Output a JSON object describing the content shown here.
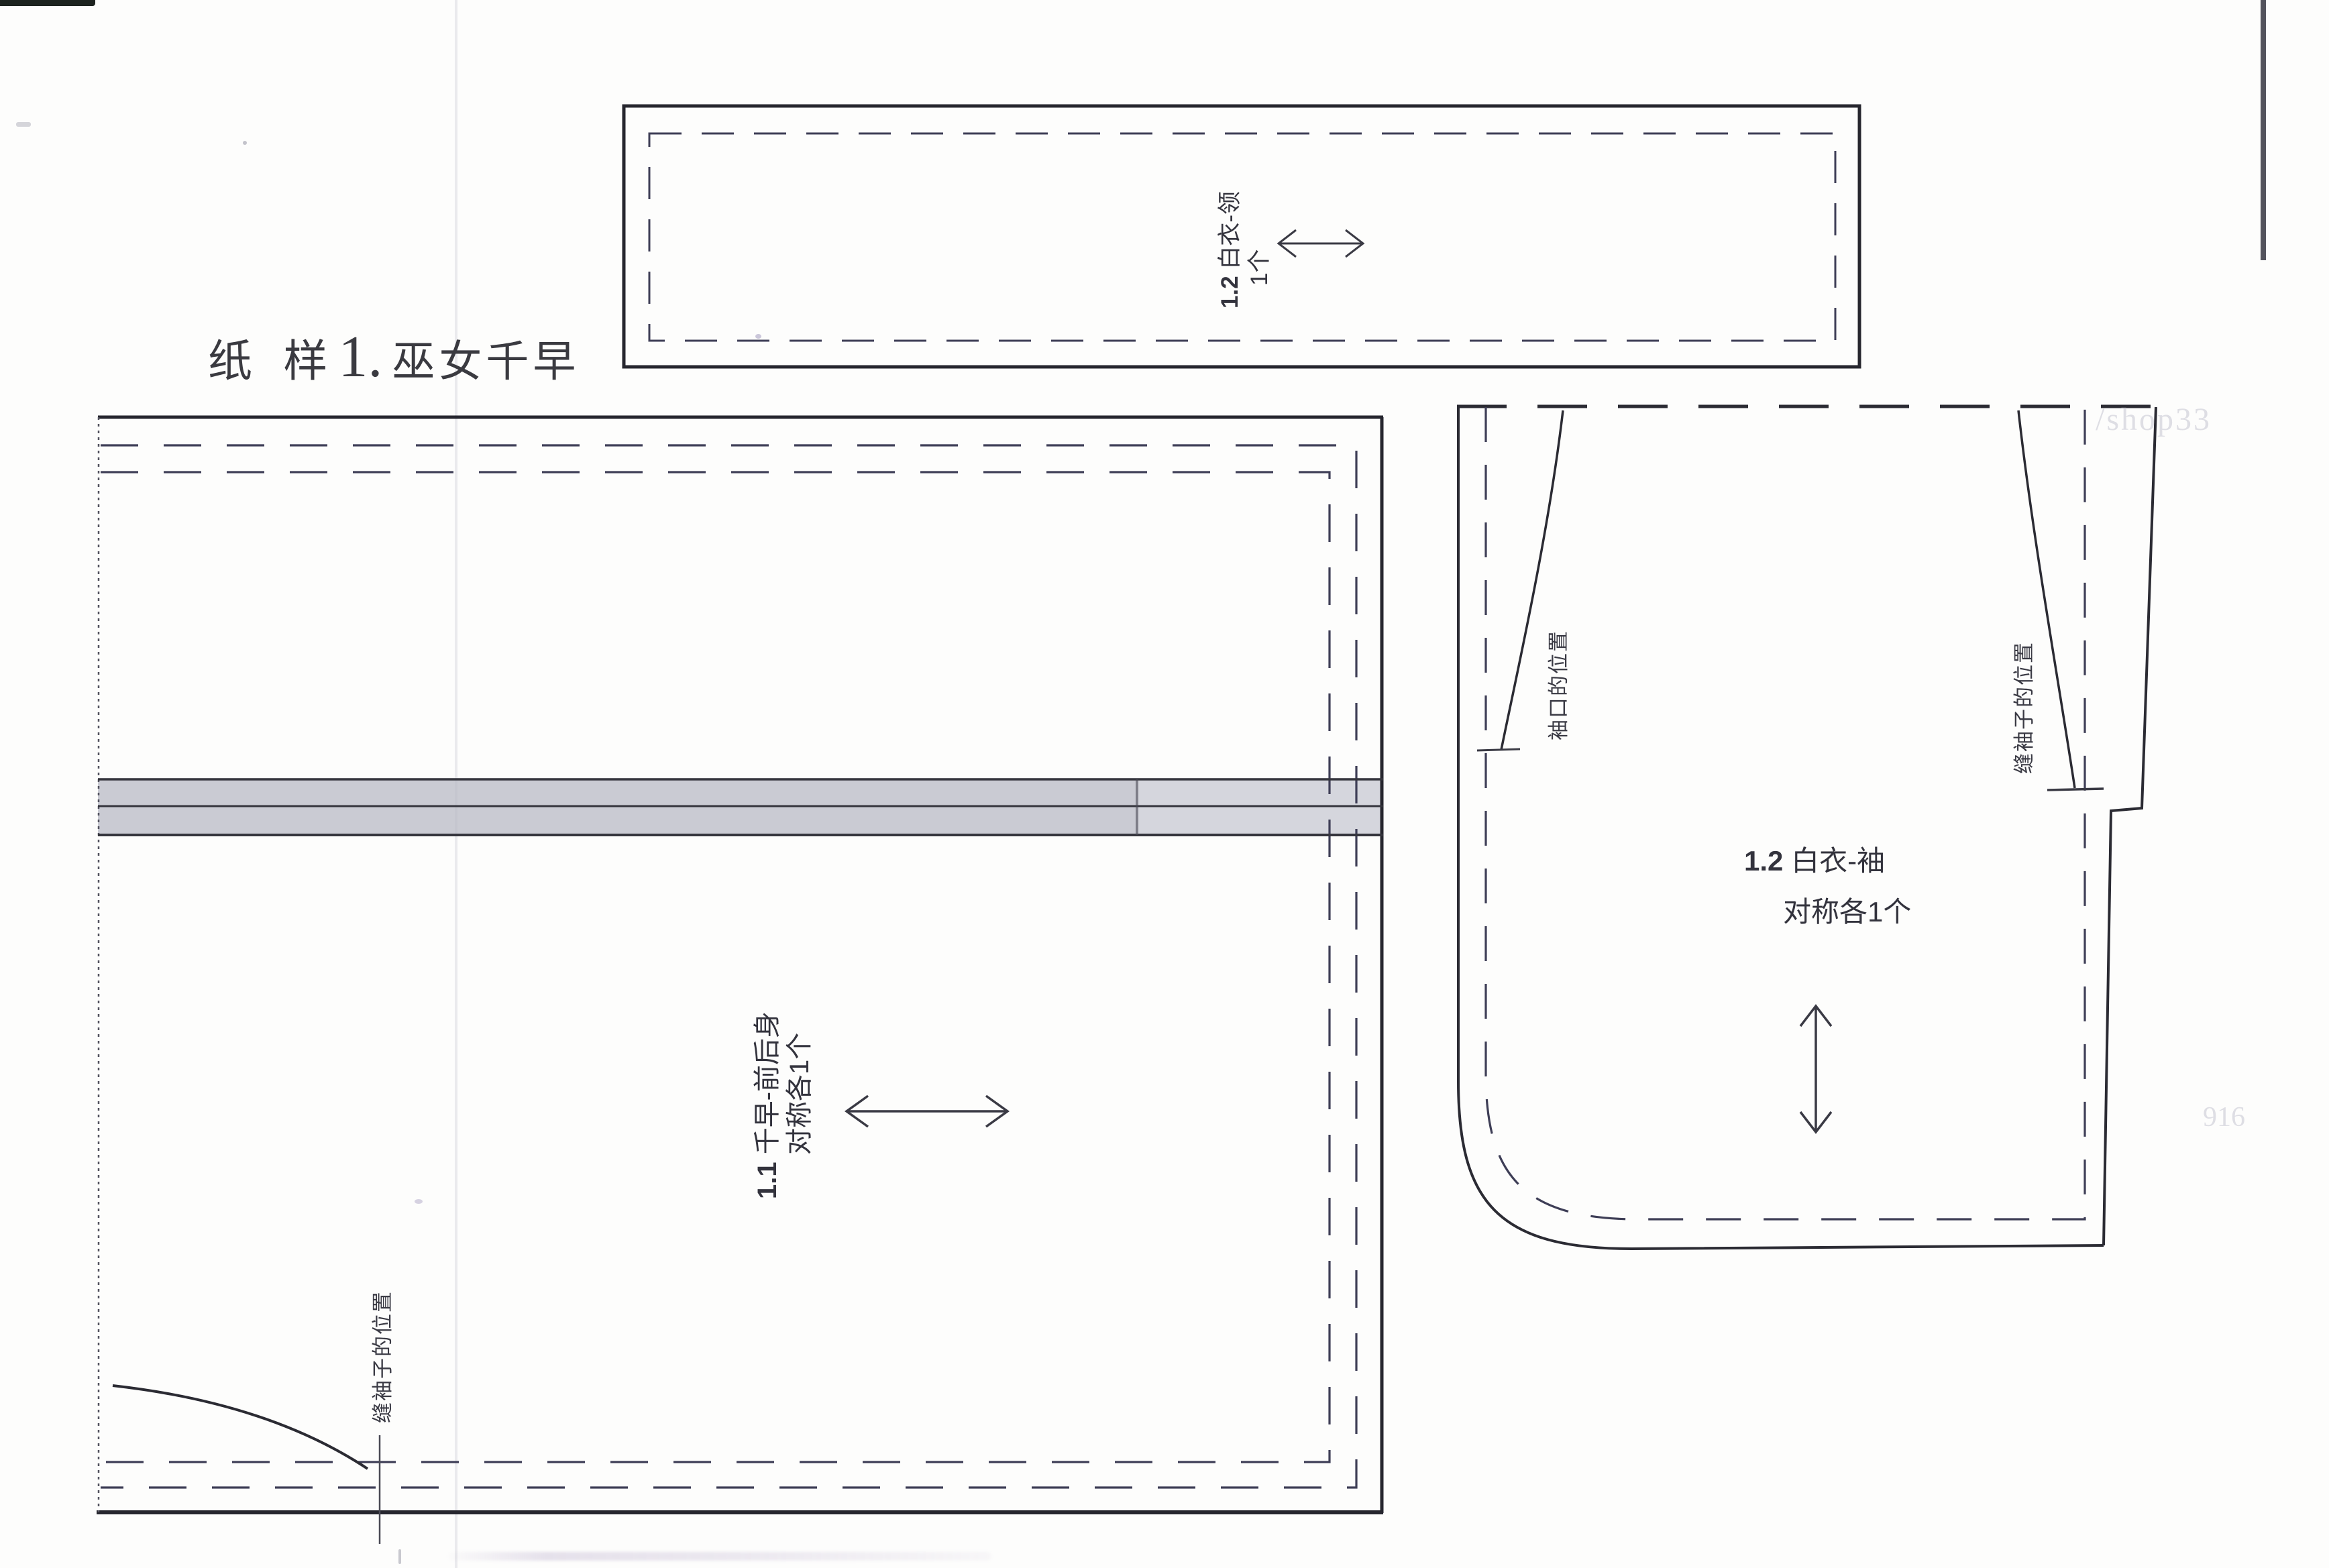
{
  "page": {
    "title_prefix": "纸 样",
    "title_num": "1.",
    "title_name": "巫女千早"
  },
  "pieces": {
    "collar": {
      "num": "1.2",
      "name": "白衣-领",
      "qty": "1个"
    },
    "body": {
      "num": "1.1",
      "name": "千早-前后身",
      "qty": "对称各1个",
      "annotation_sew": "缝袖子的位置"
    },
    "sleeve": {
      "num": "1.2",
      "name": "白衣-袖",
      "qty": "对称各1个",
      "annotation_cuff": "袖口的位置",
      "annotation_sew": "缝袖子的位置"
    }
  },
  "watermarks": {
    "shop": "/shop33",
    "num": "916"
  },
  "colors": {
    "paper": "#fdfdfc",
    "ink": "#2b2b33",
    "dash_line": "#3e3e56",
    "band_dark": "#cacbd3",
    "band_light": "#d5d6dd"
  }
}
